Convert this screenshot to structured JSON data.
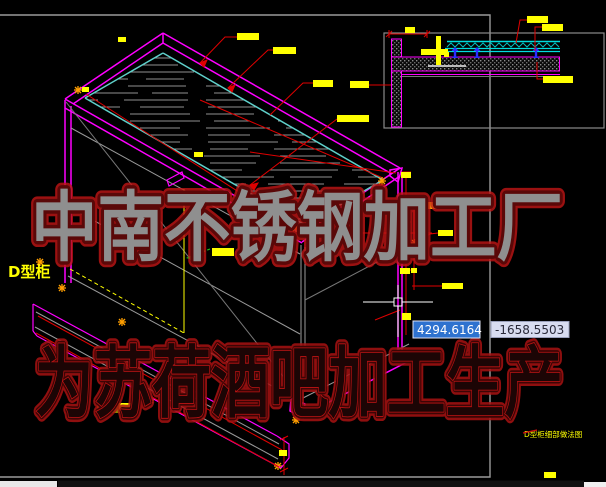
{
  "app": {
    "type": "cad-viewport",
    "background": "#000000"
  },
  "drawing": {
    "cabinet_label": "D型柜",
    "sheet_title_small": "D型柜细部做法图",
    "watermark_line1": "中南不锈钢加工厂",
    "watermark_line2": "为苏荷酒吧加工生产"
  },
  "dynamic_input": {
    "x_value": "4294.6164",
    "y_value": "-1658.5503"
  },
  "icons": {
    "crosshair": "crosshair-cursor",
    "pickbox": "pickbox-square",
    "leader_marker": "asterisk-snap-marker"
  },
  "colors": {
    "outline_magenta": "#ff00ff",
    "panel_cyan": "#5fd0ca",
    "leader_red": "#e00000",
    "highlight_yellow": "#ffff00",
    "marker_orange": "#ff9f00",
    "bolt_blue": "#2b2bff",
    "border_gray": "#9a9a9a",
    "watermark_red": "#b01010",
    "input_active_bg": "#2e72cf",
    "input_inactive_bg": "#d8dcf0"
  }
}
